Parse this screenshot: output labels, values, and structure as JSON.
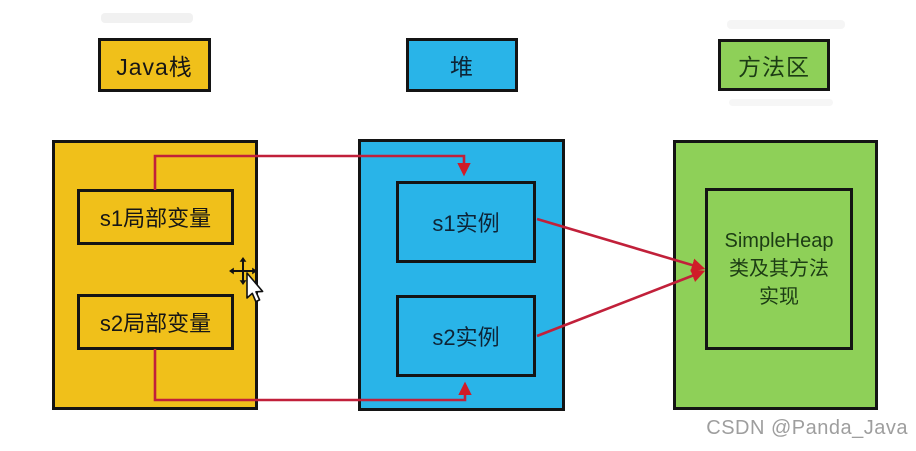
{
  "colors": {
    "stack_fill": "#f0c01a",
    "heap_fill": "#29b4e8",
    "method_fill": "#8ed058",
    "outline": "#141414",
    "arrow_red": "#c1203a",
    "watermark_gray": "#9e9e9e"
  },
  "stack": {
    "label": "Java栈",
    "vars": [
      "s1局部变量",
      "s2局部变量"
    ]
  },
  "heap": {
    "label": "堆",
    "instances": [
      "s1实例",
      "s2实例"
    ]
  },
  "method_area": {
    "label": "方法区",
    "box_lines": [
      "SimpleHeap",
      "类及其方法",
      "实现"
    ]
  },
  "references": [
    {
      "from": "s1局部变量",
      "to": "s1实例"
    },
    {
      "from": "s2局部变量",
      "to": "s2实例"
    },
    {
      "from": "s1实例",
      "to": "SimpleHeap类及其方法实现"
    },
    {
      "from": "s2实例",
      "to": "SimpleHeap类及其方法实现"
    }
  ],
  "icons": {
    "cursor": "move-crosshair-with-pointer"
  },
  "watermark": {
    "text": "CSDN @Panda_Java"
  }
}
